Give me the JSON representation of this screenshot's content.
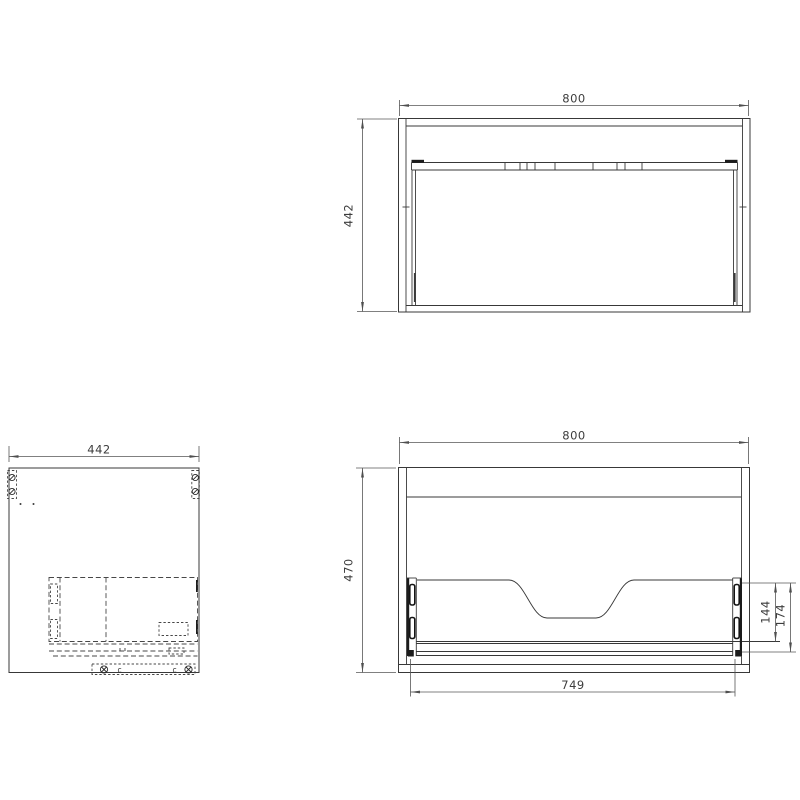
{
  "dimensions": {
    "plan_width": "800",
    "plan_depth": "442",
    "side_depth": "442",
    "front_width": "800",
    "front_height": "470",
    "drawer_back_height": "144",
    "drawer_total_height": "174",
    "front_inner_width": "749"
  },
  "marks": {
    "cam_left": "c",
    "cam_right": "c"
  },
  "colors": {
    "background": "#ffffff",
    "geometry_line": "#383838",
    "hidden_line": "#474747",
    "dimension_line": "#565656",
    "text": "#3d3d3d"
  }
}
